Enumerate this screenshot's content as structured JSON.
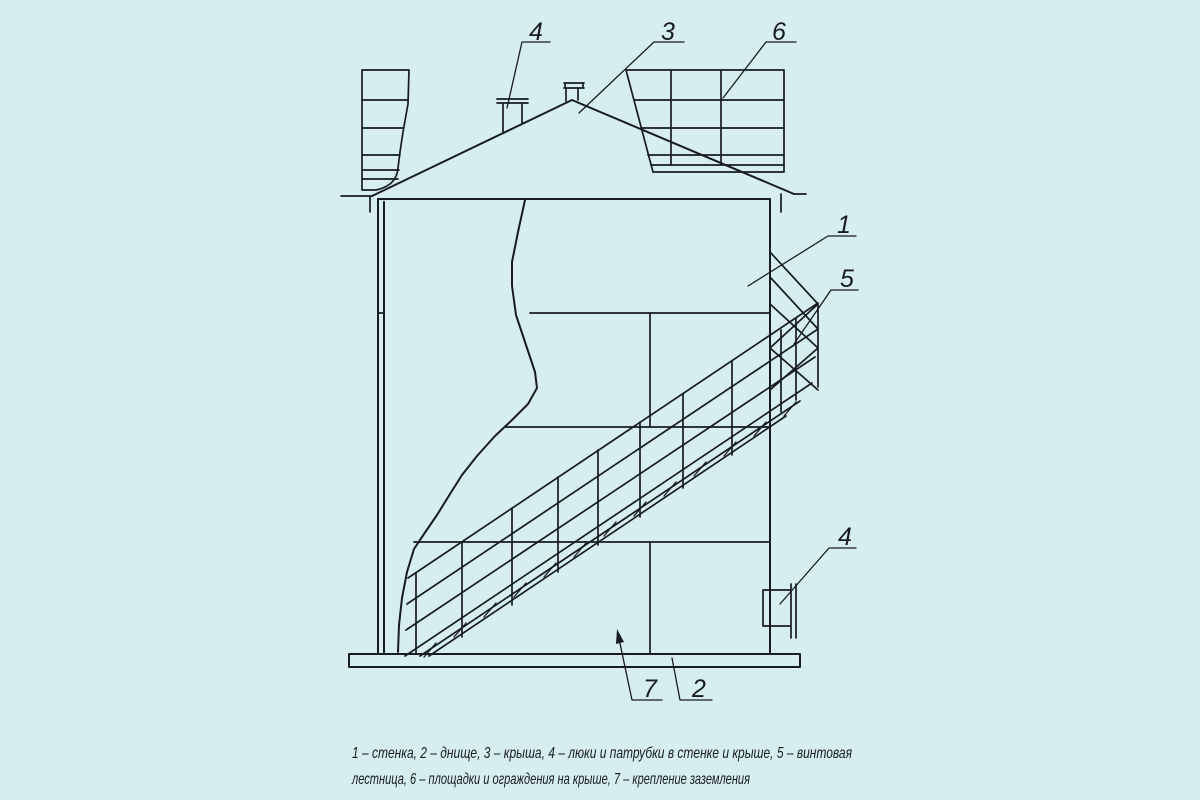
{
  "palette": {
    "background": "#d6eef0",
    "ink": "#171b24"
  },
  "callouts": {
    "wall": "1",
    "bottom": "2",
    "roof": "3",
    "roof_nozzle": "4",
    "wall_nozzle": "4",
    "stair": "5",
    "roof_platform": "6",
    "grounding": "7"
  },
  "caption": {
    "line1": "1 – стенка, 2 – днище, 3 – крыша, 4 – люки и патрубки в стенке и крыше, 5 – винтовая",
    "line2": "лестница, 6 – площадки и ограждения на крыше, 7 – крепление заземления"
  }
}
